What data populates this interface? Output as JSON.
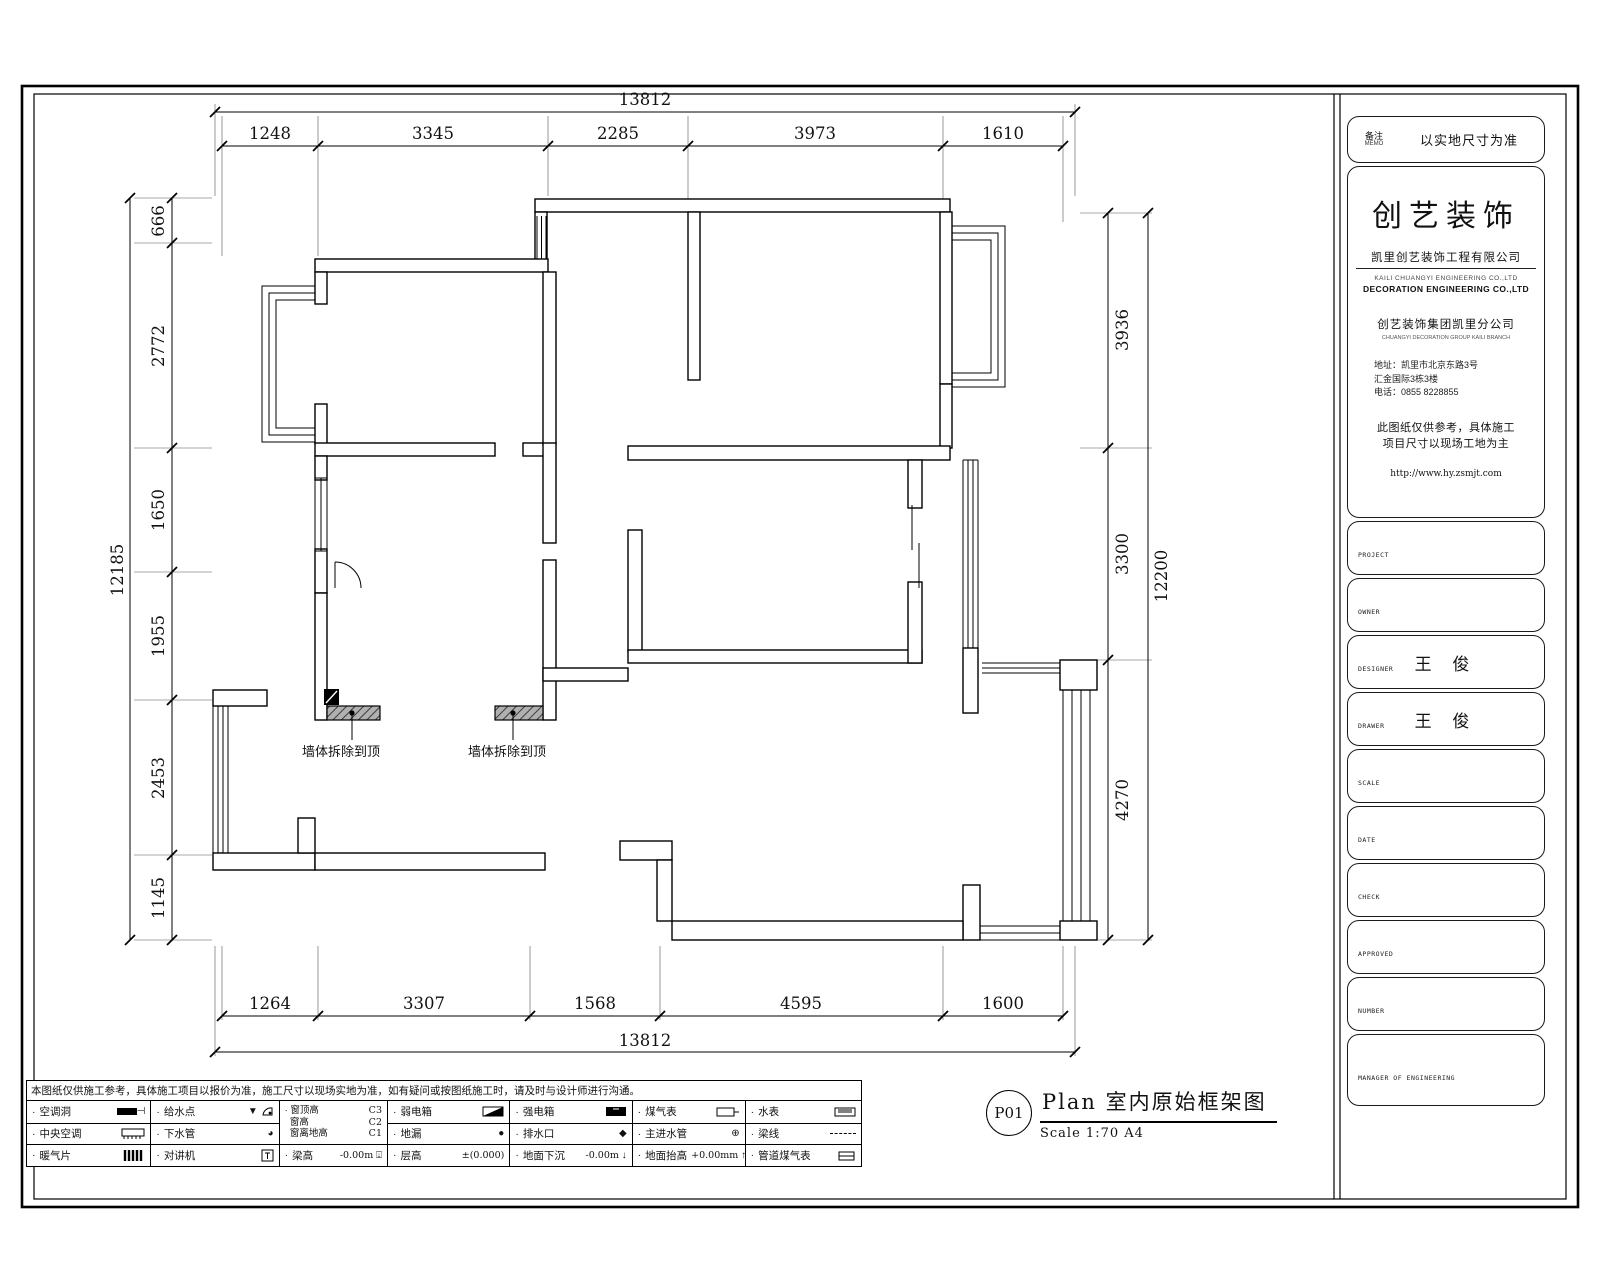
{
  "sheet": {
    "memo_label": "备注",
    "memo_label_en": "MEMO",
    "memo_value": "以实地尺寸为准",
    "company": {
      "brand": "创艺装饰",
      "name_cn": "凯里创艺装饰工程有限公司",
      "name_en_1": "KAILI CHUANGYI ENGINEERING CO.,LTD",
      "name_en_2": "DECORATION ENGINEERING CO.,LTD",
      "branch_cn": "创艺装饰集团凯里分公司",
      "branch_en": "CHUANGYI DECORATION GROUP KAILI BRANCH",
      "addr_1": "地址：凯里市北京东路3号",
      "addr_2": "汇金国际3栋3楼",
      "tel": "电话：0855 8228855",
      "note_1": "此图纸仅供参考，具体施工",
      "note_2": "项目尺寸以现场工地为主",
      "url": "http://www.hy.zsmjt.com"
    },
    "fields": [
      {
        "label": "PROJECT",
        "value": ""
      },
      {
        "label": "OWNER",
        "value": ""
      },
      {
        "label": "DESIGNER",
        "value": "王 俊"
      },
      {
        "label": "DRAWER",
        "value": "王 俊"
      },
      {
        "label": "SCALE",
        "value": ""
      },
      {
        "label": "DATE",
        "value": ""
      },
      {
        "label": "CHECK",
        "value": ""
      },
      {
        "label": "APPROVED",
        "value": ""
      },
      {
        "label": "NUMBER",
        "value": ""
      },
      {
        "label": "MANAGER OF ENGINEERING",
        "value": ""
      }
    ]
  },
  "dims": {
    "top_total": "13812",
    "top": [
      "1248",
      "3345",
      "2285",
      "3973",
      "1610"
    ],
    "bottom": [
      "1264",
      "3307",
      "1568",
      "4595",
      "1600"
    ],
    "bottom_total": "13812",
    "left_total": "12185",
    "left": [
      "666",
      "2772",
      "1650",
      "1955",
      "2453",
      "1145"
    ],
    "right": [
      "3936",
      "3300",
      "4270"
    ],
    "right_total": "12200"
  },
  "plan": {
    "demo_label": "墙体拆除到顶"
  },
  "titlebar": {
    "page": "P01",
    "name": "Plan  室内原始框架图",
    "scale": "Scale 1:70  A4"
  },
  "legend": {
    "note": "本图纸仅供施工参考，具体施工项目以报价为准，施工尺寸以现场实地为准，如有疑问或按图纸施工时，请及时与设计师进行沟通。",
    "c1r1": "空调洞",
    "c1r2": "中央空调",
    "c1r3": "暖气片",
    "c2r1": "给水点",
    "c2r2": "下水管",
    "c2r3": "对讲机",
    "c3m1l": "窗顶高",
    "c3m1v": "C3",
    "c3m2l": "窗高",
    "c3m2v": "C2",
    "c3m3l": "窗离地高",
    "c3m3v": "C1",
    "c3r3": "梁高",
    "c3r3v": "-0.00m",
    "c4r1": "弱电箱",
    "c4r2": "地漏",
    "c4r3": "层高",
    "c4r3v": "±(0.000)",
    "c5r1": "强电箱",
    "c5r2": "排水口",
    "c5r3": "地面下沉",
    "c5r3v": "-0.00m",
    "c6r1": "煤气表",
    "c6r2": "主进水管",
    "c6r3": "地面抬高",
    "c6r3v": "+0.00mm",
    "c7r1": "水表",
    "c7r2": "梁线",
    "c7r3": "管道煤气表"
  }
}
